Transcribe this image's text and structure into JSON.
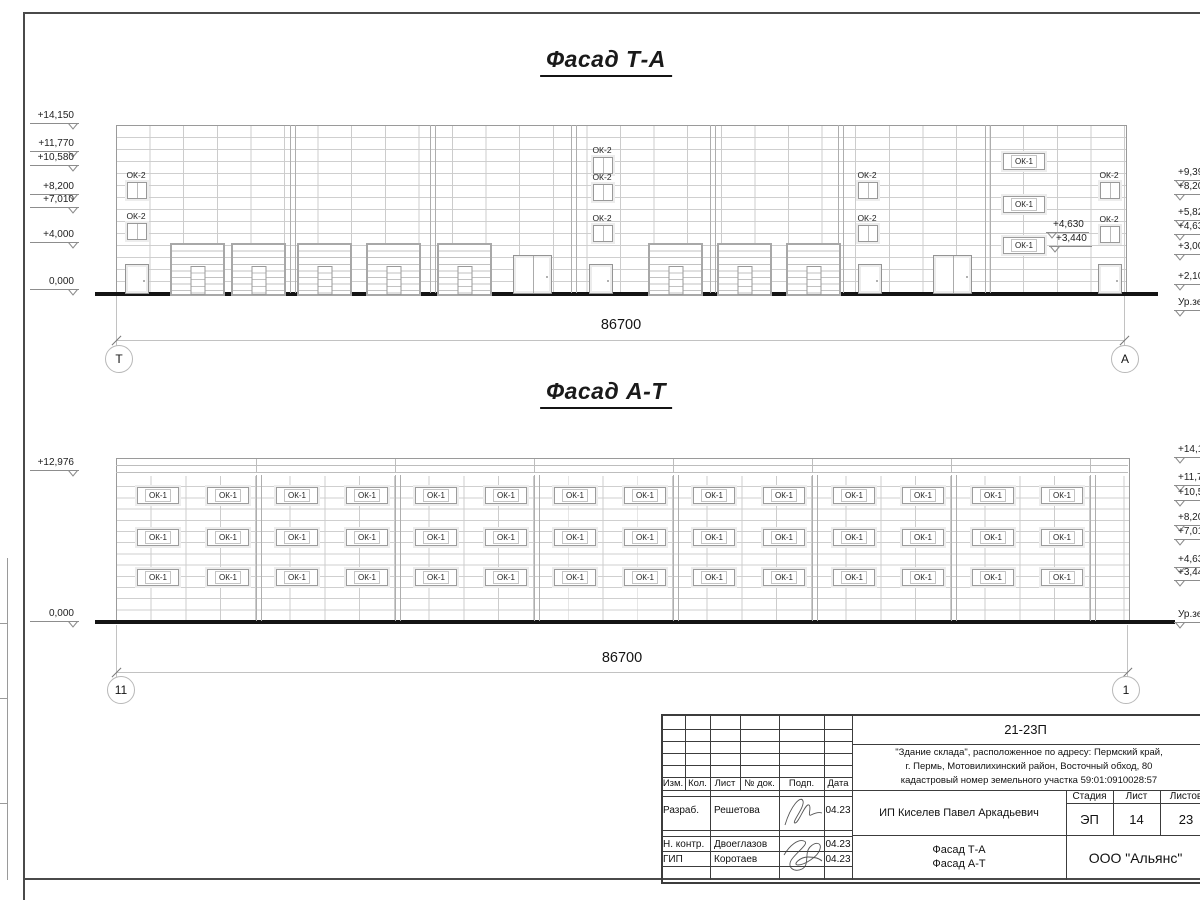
{
  "titles": {
    "top": "Фасад Т-А",
    "bottom": "Фасад А-Т"
  },
  "dims": {
    "top": "86700",
    "bottom": "86700"
  },
  "axes": {
    "top_left": "Т",
    "top_right": "А",
    "bottom_left": "11",
    "bottom_right": "1"
  },
  "labels": {
    "ok1": "ОК-1",
    "ok2": "ОК-2"
  },
  "elevations": {
    "top_left": [
      {
        "t": "+14,150",
        "y": 110
      },
      {
        "t": "+11,770",
        "y": 138
      },
      {
        "t": "+10,580",
        "y": 152
      },
      {
        "t": "+8,200",
        "y": 181
      },
      {
        "t": "+7,010",
        "y": 194
      },
      {
        "t": "+4,000",
        "y": 229
      },
      {
        "t": "0,000",
        "y": 276
      }
    ],
    "top_right": [
      {
        "t": "+9,39",
        "y": 167
      },
      {
        "t": "+8,20",
        "y": 181
      },
      {
        "t": "+5,82",
        "y": 207
      },
      {
        "t": "+4,63",
        "y": 221
      },
      {
        "t": "+3,00",
        "y": 241
      },
      {
        "t": "+2,10",
        "y": 271
      },
      {
        "t": "Ур.зе",
        "y": 297
      }
    ],
    "top_mid": [
      {
        "t": "+4,630",
        "x": 1046,
        "y": 219
      },
      {
        "t": "+3,440",
        "x": 1049,
        "y": 233
      }
    ],
    "bottom_left": [
      {
        "t": "+12,976",
        "y": 457
      },
      {
        "t": "0,000",
        "y": 608
      }
    ],
    "bottom_right": [
      {
        "t": "+14,15",
        "y": 444
      },
      {
        "t": "+11,77",
        "y": 472
      },
      {
        "t": "+10,58",
        "y": 487
      },
      {
        "t": "+8,20",
        "y": 512
      },
      {
        "t": "+7,01",
        "y": 526
      },
      {
        "t": "+4,63",
        "y": 554
      },
      {
        "t": "+3,44",
        "y": 567
      },
      {
        "t": "Ур.зем",
        "y": 609
      }
    ]
  },
  "titleblock": {
    "code": "21-23П",
    "desc1": "\"Здание склада\", расположенное по адресу: Пермский край,",
    "desc2": "г. Пермь, Мотовилихинский район, Восточный обход, 80",
    "desc3": "кадастровый номер земельного участка 59:01:0910028:57",
    "client": "ИП Киселев Павел Аркадьевич",
    "stage_h": "Стадия",
    "sheet_h": "Лист",
    "sheets_h": "Листов",
    "stage": "ЭП",
    "sheet": "14",
    "sheets": "23",
    "drawing1": "Фасад Т-А",
    "drawing2": "Фасад А-Т",
    "company": "ООО \"Альянс\"",
    "h_izm": "Изм.",
    "h_kol": "Кол.",
    "h_list": "Лист",
    "h_doc": "№ док.",
    "h_podp": "Подп.",
    "h_data": "Дата",
    "r1_role": "Разраб.",
    "r1_name": "Решетова",
    "r1_date": "04.23",
    "r2_role": "Н. контр.",
    "r2_name": "Двоеглазов",
    "r2_date": "04.23",
    "r3_role": "ГИП",
    "r3_name": "Коротаев",
    "r3_date": "04.23"
  },
  "geometry": {
    "top": {
      "body": {
        "x": 116,
        "y": 125,
        "w": 1009,
        "h": 168
      },
      "ground": {
        "x": 95,
        "y": 292,
        "w": 1063
      },
      "bays": [
        290,
        430,
        571,
        710,
        838,
        985
      ],
      "gates": [
        170,
        231,
        297,
        366,
        437,
        648,
        717,
        786
      ],
      "gate_w": 51,
      "gate_y": 243,
      "gate_h": 49,
      "doors": [
        125,
        589,
        858,
        1098
      ],
      "door_y": 264,
      "door_w": 22,
      "door_h": 28,
      "ddoors": [
        513,
        933
      ],
      "ddoor_y": 255,
      "ddoor_w": 37,
      "ddoor_h": 37,
      "ok2": [
        [
          127,
          182
        ],
        [
          127,
          223
        ],
        [
          593,
          157
        ],
        [
          593,
          184
        ],
        [
          593,
          225
        ],
        [
          858,
          182
        ],
        [
          858,
          225
        ],
        [
          1100,
          182
        ],
        [
          1100,
          226
        ]
      ],
      "ok2_w": 18,
      "ok2_h": 15,
      "ok1_x": 1003,
      "ok1_rows": [
        153,
        196,
        237
      ],
      "ok1_w": 40,
      "ok1_h": 15
    },
    "bottom": {
      "body": {
        "x": 116,
        "y": 458,
        "w": 1012,
        "h": 163
      },
      "grid_top": 17,
      "ground": {
        "x": 95,
        "y": 620,
        "w": 1080
      },
      "bays": [
        256,
        395,
        534,
        673,
        812,
        951,
        1090
      ],
      "parapet_lines": [
        7,
        14
      ],
      "ok1_x0": 137,
      "ok1_pitch": 69.55,
      "ok1_count": 14,
      "ok1_rows": [
        487,
        529,
        569
      ],
      "ok1_w": 40,
      "ok1_h": 15
    },
    "titleblock_lines": {
      "v": [
        [
          685,
          714,
          790
        ],
        [
          710,
          714,
          880
        ],
        [
          740,
          714,
          790
        ],
        [
          779,
          714,
          880
        ],
        [
          824,
          714,
          880
        ],
        [
          852,
          714,
          880
        ],
        [
          1066,
          790,
          880
        ],
        [
          1113,
          790,
          835
        ],
        [
          1160,
          790,
          835
        ]
      ],
      "h": [
        [
          729,
          661,
          852
        ],
        [
          741,
          661,
          852
        ],
        [
          753,
          661,
          852
        ],
        [
          765,
          661,
          852
        ],
        [
          777,
          661,
          852
        ],
        [
          790,
          661,
          1205
        ],
        [
          796,
          661,
          852
        ],
        [
          830,
          661,
          852
        ],
        [
          836,
          661,
          852
        ],
        [
          851,
          661,
          852
        ],
        [
          866,
          661,
          852
        ],
        [
          744,
          852,
          1205
        ],
        [
          803,
          1066,
          1205
        ],
        [
          835,
          852,
          1205
        ]
      ]
    }
  }
}
